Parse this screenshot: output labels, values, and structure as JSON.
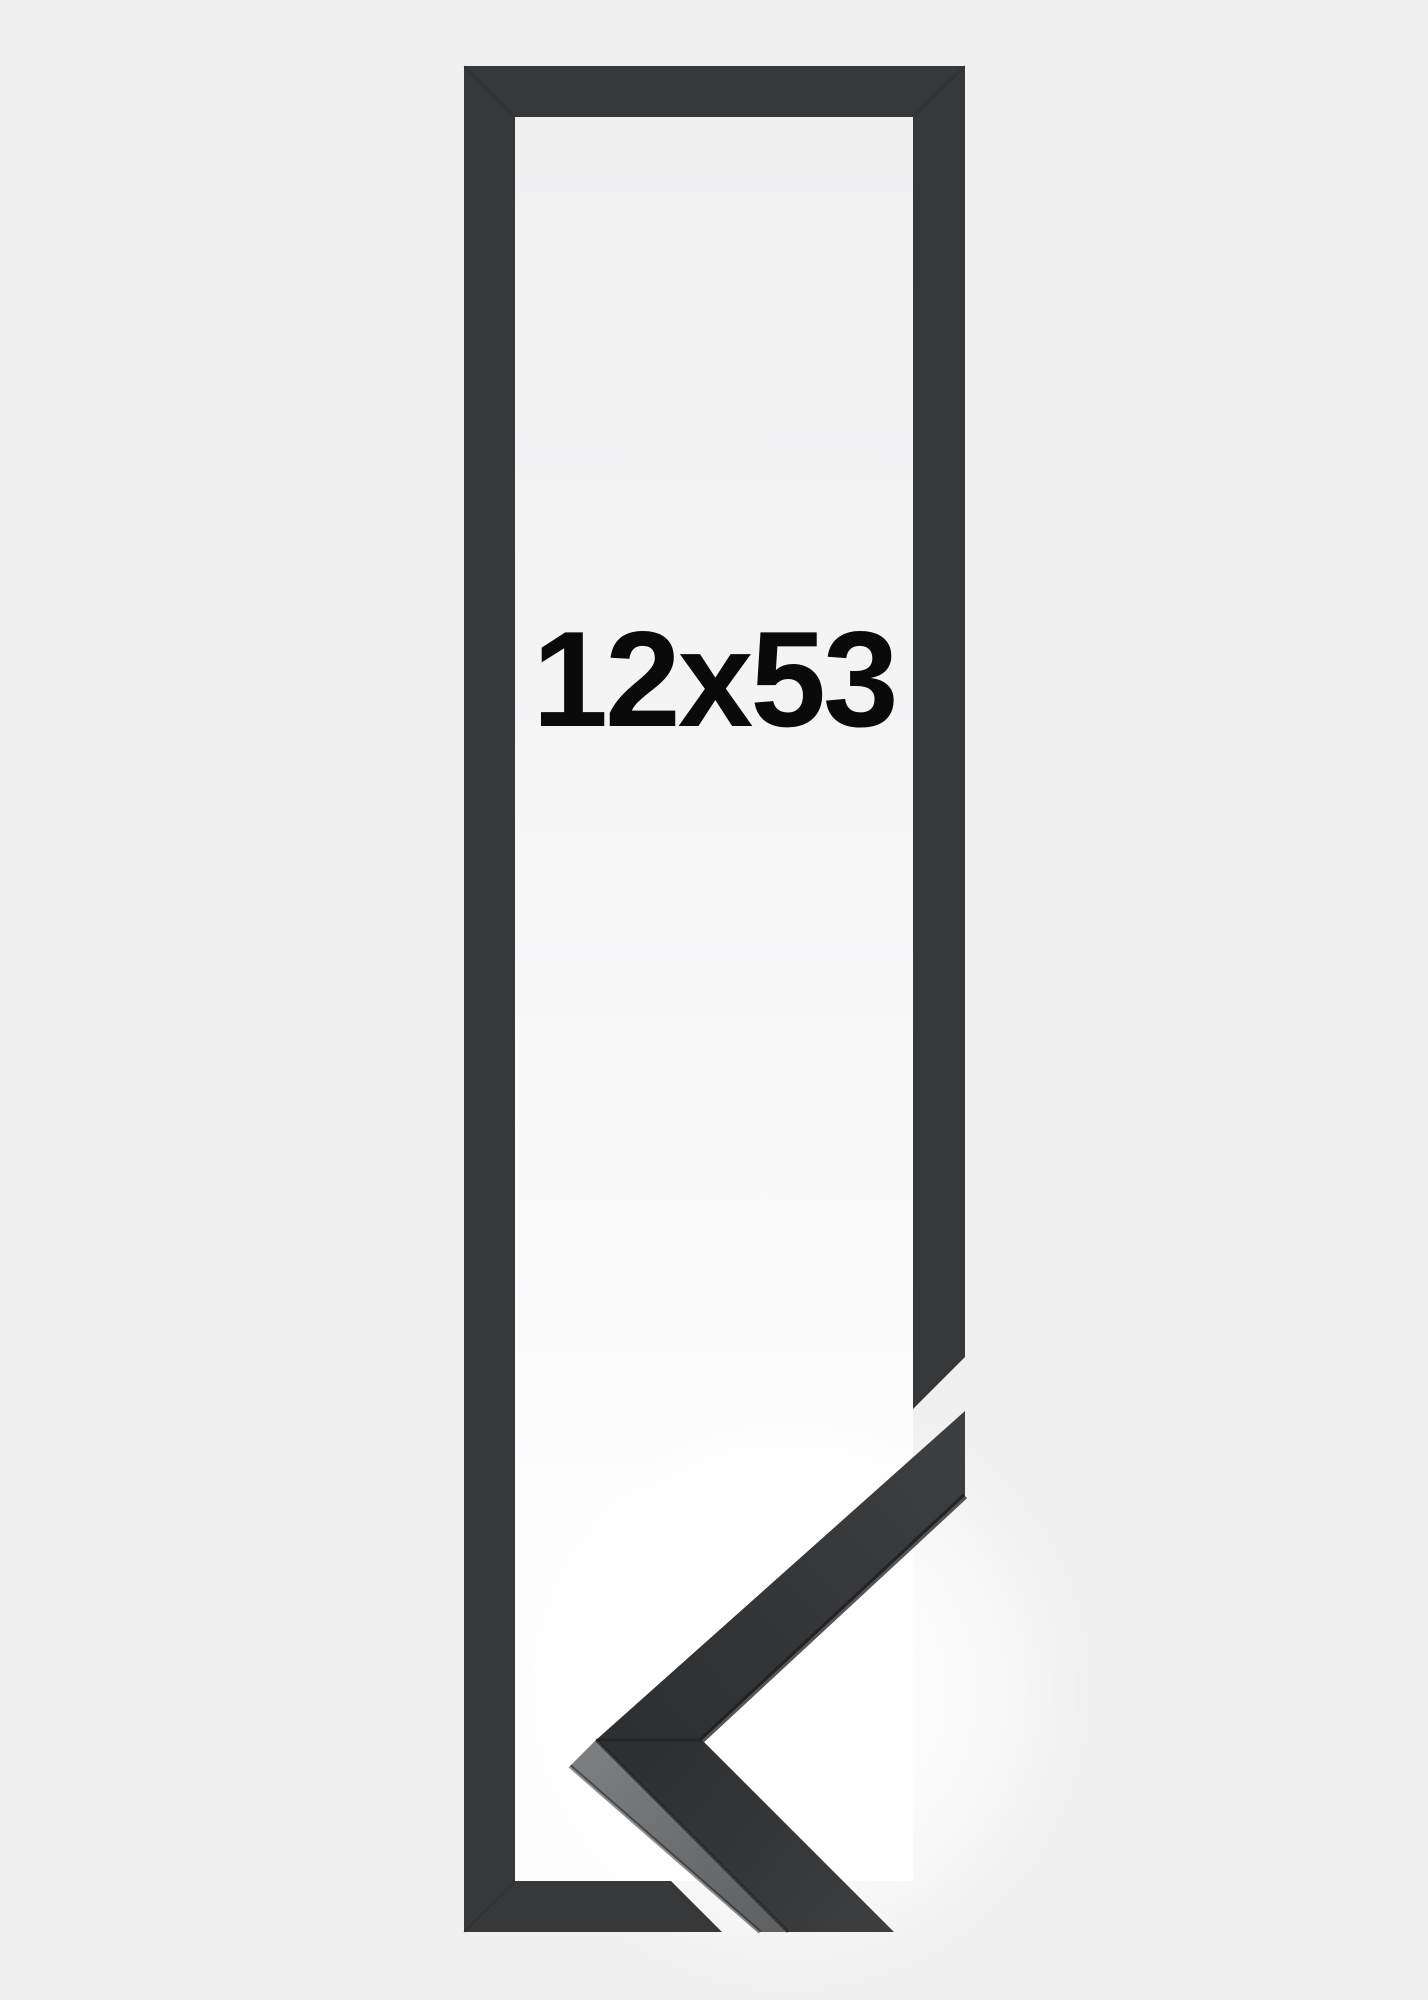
{
  "page": {
    "background": "#f0f0f1"
  },
  "product_image": {
    "size_label": "12x53",
    "colors": {
      "illustration_bar": "#36383a",
      "miter_seam": "rgba(15,16,18,0.28)",
      "interior_top": "#f0f0f1",
      "interior_mid": "#f6f6f7",
      "interior_bottom": "#fdfdfe",
      "glow": "#ffffff",
      "photo_face_light": "#3c3e40",
      "photo_face_dark": "#2d2f31",
      "photo_side_light": "#7b7d7f",
      "photo_side_dark": "#5e6062",
      "photo_edge": "#1b1c1e",
      "label": "#0a0a0b"
    }
  }
}
